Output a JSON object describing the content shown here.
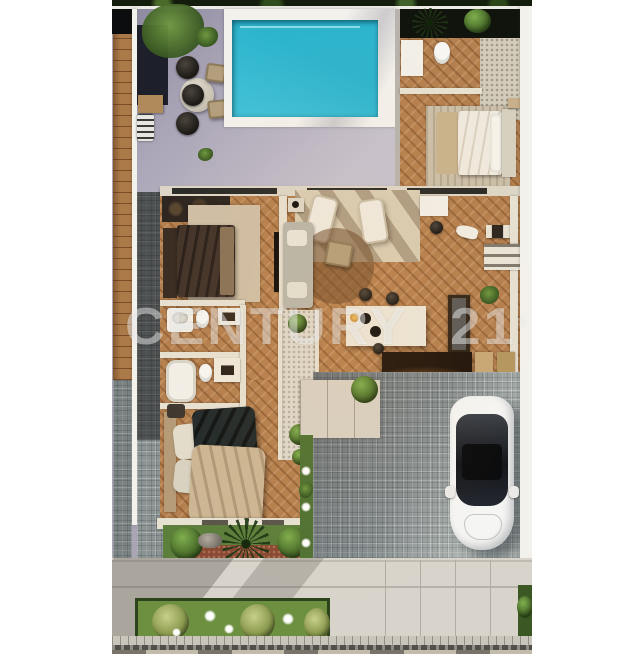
{
  "meta": {
    "kind": "aerial-3d-architectural-render",
    "description": "Top-down 3D rendering of a single-storey villa: swimming pool and patio at top, furnished interior rooms in the middle, driveway with parked white car, front garden, sidewalk and street at bottom. White page margins left and right.",
    "width_px": 630,
    "height_px": 654
  },
  "watermark": {
    "text": "CENTURY 21",
    "word1": "CENTURY",
    "word2": "21",
    "registered_symbol": "®"
  },
  "palette": {
    "page_bg": "#ffffff",
    "tree_canopy": "#141d0c",
    "back_wall": "#eceae4",
    "wood_floor": "#b5804f",
    "wood_plank": "#ac7a48",
    "patio": "#aba6b7",
    "pool_water": "#2db4cd",
    "pool_deck": "#f3f1ec",
    "wall_cream": "#e7e1d2",
    "wall_white": "#f3f1ec",
    "terrace": "#d9cdb4",
    "rug_beige": "#cbbfa9",
    "sofa_gray": "#b9b7ab",
    "rattan": "#b49f7c",
    "furniture_dark": "#2e2620",
    "island_white": "#ece7da",
    "counter_dark": "#20150c",
    "cabinet_tan": "#c8a876",
    "paver": "#9aa3a4",
    "sidewalk": "#d8d4cb",
    "curb": "#c9c5bb",
    "street_dark": "#514f4a",
    "street_light": "#c2bbaa",
    "grass": "#5d7f3c",
    "lawn": "#6c9040",
    "shrub_dark": "#39591f",
    "shrub_light": "#7fae4e",
    "bush_yellow": "#8a9a4e",
    "gravel_red": "#8a4a33",
    "gravel_white": "#ded9cc",
    "car_body": "#f5f5f3",
    "car_glass": "#1b1d22",
    "watermark": "rgba(255,255,255,0.45)"
  },
  "scene": {
    "margins": [
      "left-white-margin",
      "right-white-margin"
    ],
    "objects": [
      "tree-canopy",
      "swimming-pool",
      "pool-deck",
      "patio",
      "outdoor-dining-set",
      "pergola-shade",
      "grill-station",
      "rear-bathroom",
      "walk-in-shower",
      "guest-bedroom-bed",
      "wardrobe",
      "second-bedroom-bed",
      "tv-panel",
      "sofa",
      "rattan-armchair",
      "lounge-chairs",
      "kitchen-island",
      "bar-stools",
      "kitchen-counter",
      "pantry-shelves",
      "bathroom-vanity",
      "bathtub",
      "toilets",
      "courtyard-gravel",
      "master-bed",
      "garden-bed",
      "fan-palm",
      "shrubs",
      "driveway-pavers",
      "white-car",
      "sidewalk",
      "front-planter",
      "street"
    ]
  }
}
